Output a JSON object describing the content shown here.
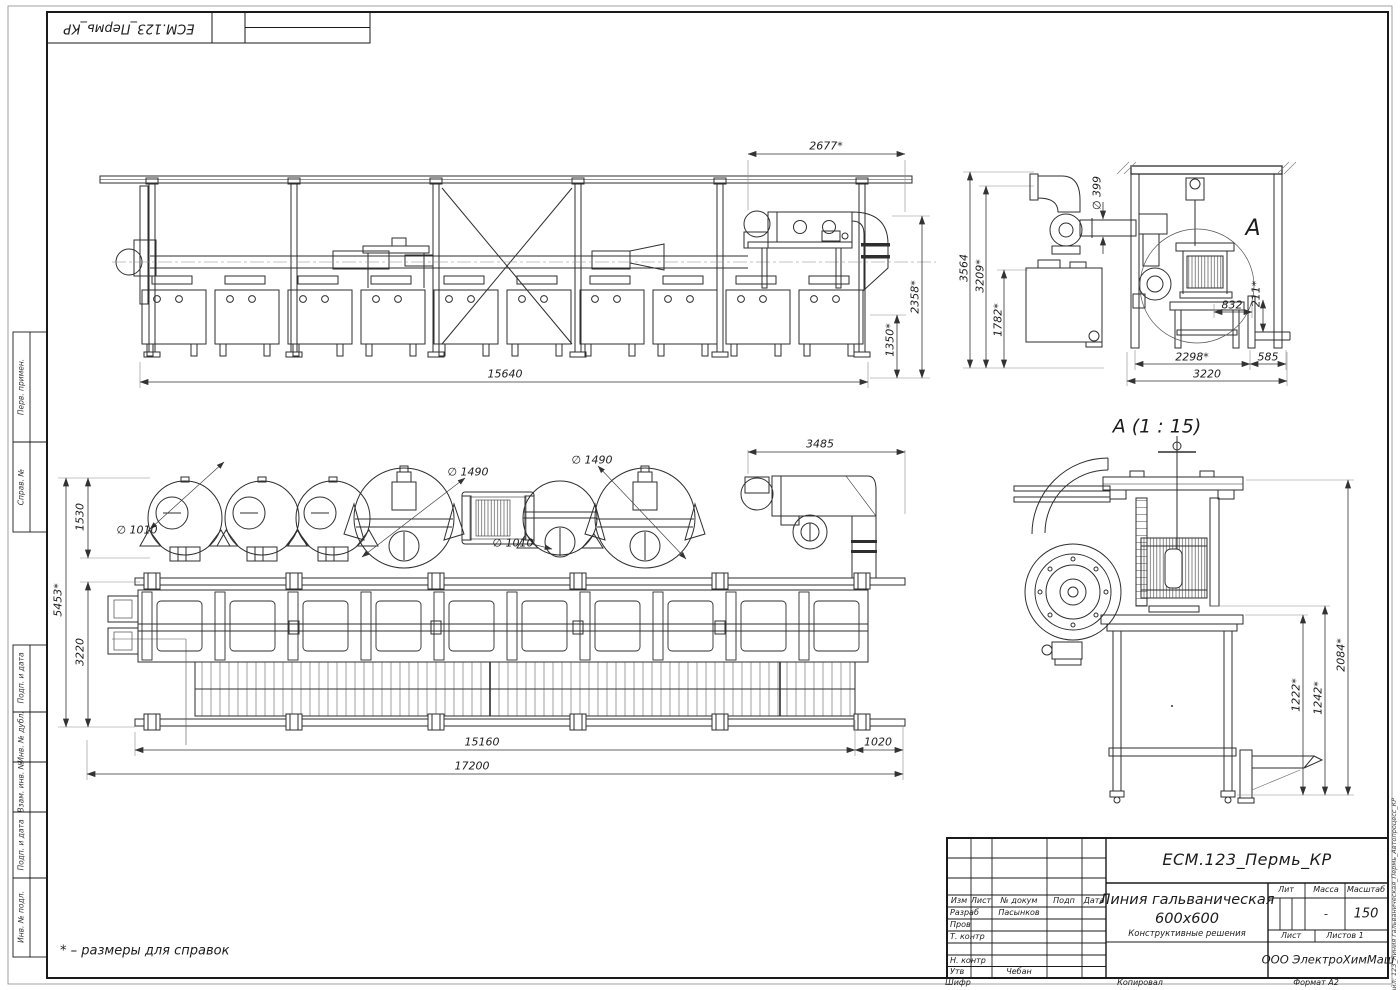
{
  "sheet": {
    "top_stamp": "ЕСМ.123_Пермь_КР",
    "note": "* – размеры для справок",
    "file_label": "Файл: 123_Линия гальваническая_Пермь_Автопроцесс_КР"
  },
  "margins": {
    "left_labels": [
      "Перв. примен.",
      "Справ. №",
      "Подп. и дата",
      "Инв. № дубл.",
      "Взам. инв. №",
      "Подп. и дата",
      "Инв. № подл."
    ]
  },
  "title_block": {
    "designation": "ЕСМ.123_Пермь_КР",
    "name_line1": "Линия гальваническая",
    "name_line2": "600х600",
    "doc_type": "Конструктивные решения",
    "company": "ООО ЭлектроХимМаш",
    "headers": {
      "izm": "Изм",
      "list": "Лист",
      "docnum": "№ докум",
      "podp": "Подп",
      "data": "Дата",
      "lit": "Лит",
      "massa": "Масса",
      "masshtab": "Масштаб",
      "list2": "Лист",
      "listov": "Листов 1"
    },
    "rows": {
      "razrab": "Разраб",
      "razrab_name": "Пасынков",
      "prov": "Пров",
      "tkontr": "Т. контр",
      "nkontr": "Н. контр",
      "utv": "Утв",
      "utv_name": "Чебан"
    },
    "values": {
      "massa": "-",
      "masshtab": "150"
    },
    "footer": {
      "shifr": "Шифр",
      "kopiroval": "Копировал",
      "format": "Формат А2"
    }
  },
  "views": {
    "front": {
      "dims": {
        "duct_w": "2677*",
        "duct_h": "2358*",
        "hood_h": "1350*",
        "length": "15640"
      }
    },
    "side": {
      "callout": "А",
      "dims": {
        "h_total": "3564",
        "h_frame": "3209*",
        "h_tank": "1782*",
        "duct_dia": "∅ 399",
        "fork": "832",
        "post": "211*",
        "w_frame": "2298*",
        "w_ext": "585",
        "w_total": "3220"
      }
    },
    "plan": {
      "dims": {
        "row_w": "1530",
        "dia1010_1": "∅ 1010",
        "dia1490_1": "∅ 1490",
        "dia1490_2": "∅ 1490",
        "dia1010_2": "∅ 1010",
        "duct": "3485",
        "w_total": "5453*",
        "w_line": "3220",
        "l_line": "15160",
        "l_ext": "1020",
        "l_total": "17200"
      }
    },
    "detail": {
      "title": "А (1 : 15)",
      "dims": {
        "h_total": "2084*",
        "h_drum": "1242*",
        "h_stand": "1222*"
      }
    }
  }
}
